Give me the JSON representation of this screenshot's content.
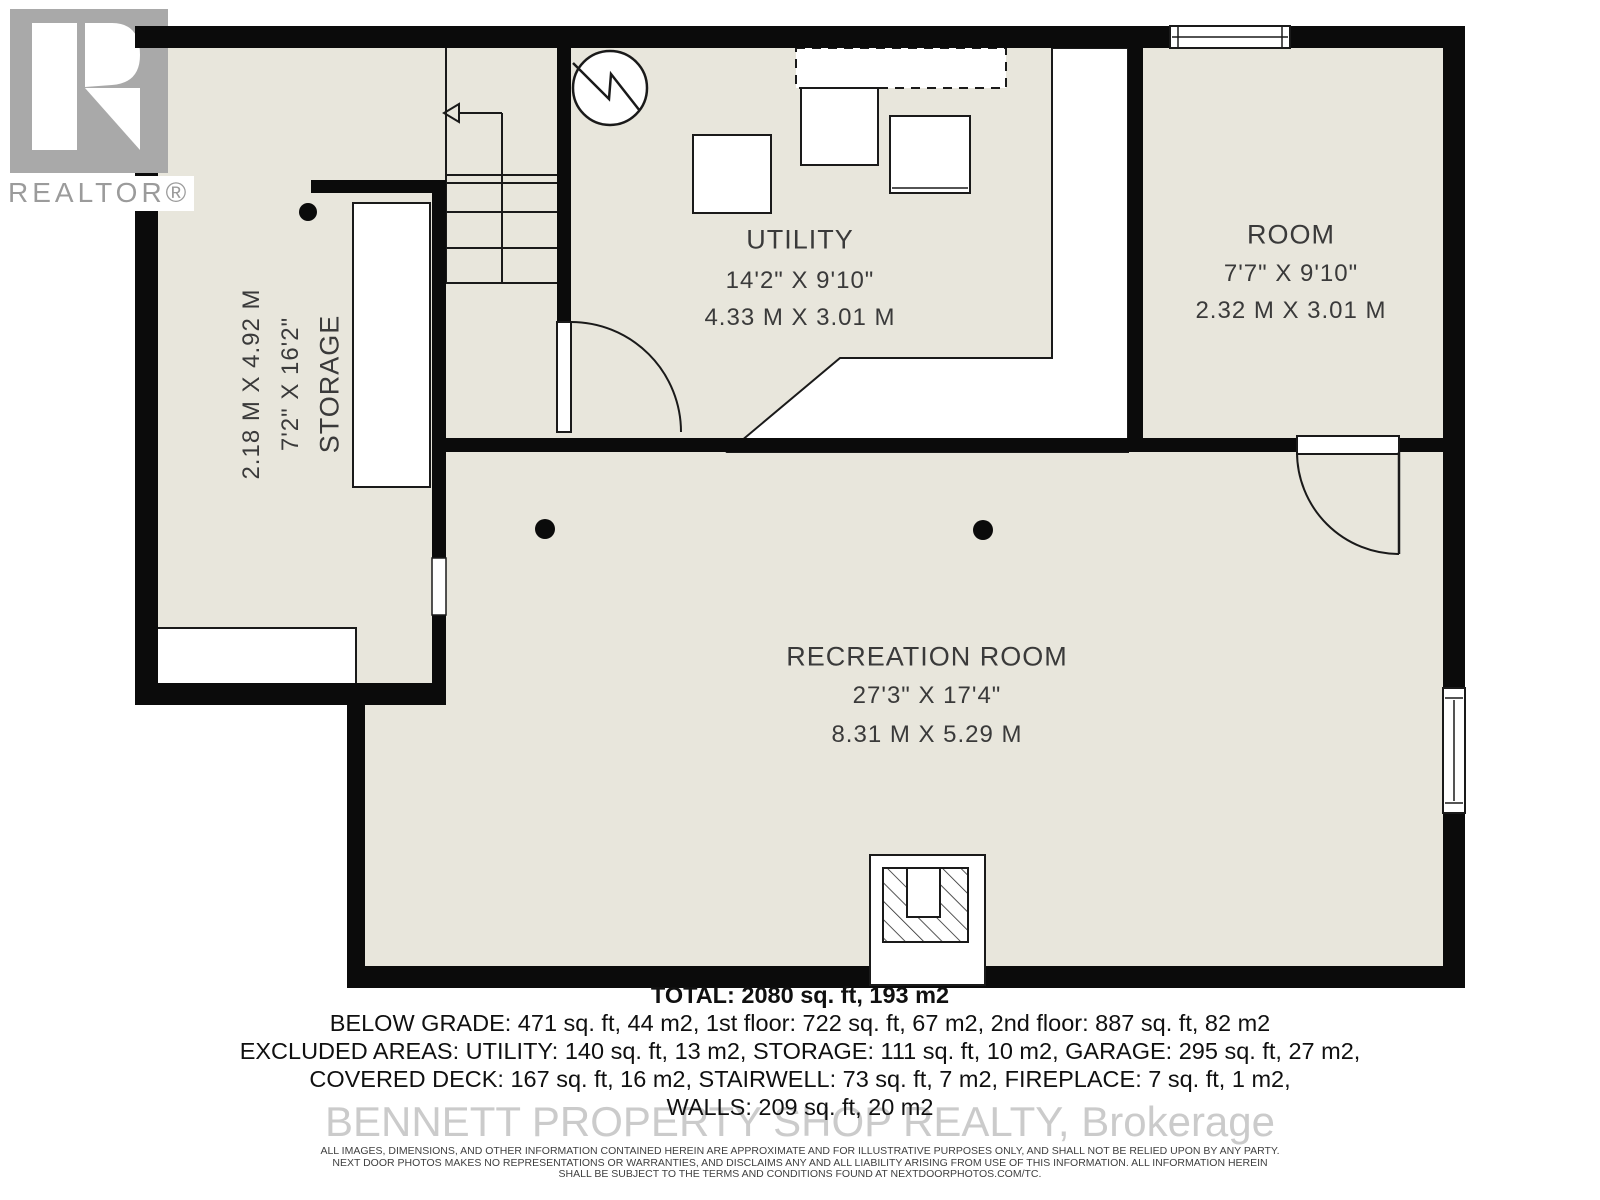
{
  "logo": {
    "brand": "REALTOR®"
  },
  "rooms": {
    "utility": {
      "name": "UTILITY",
      "dim_imperial": "14'2\" X 9'10\"",
      "dim_metric": "4.33 M X 3.01 M"
    },
    "room": {
      "name": "ROOM",
      "dim_imperial": "7'7\" X 9'10\"",
      "dim_metric": "2.32 M X 3.01 M"
    },
    "recreation": {
      "name": "RECREATION ROOM",
      "dim_imperial": "27'3\" X 17'4\"",
      "dim_metric": "8.31 M X 5.29 M"
    },
    "storage": {
      "name": "STORAGE",
      "dim_imperial": "7'2\" X 16'2\"",
      "dim_metric": "2.18 M X 4.92 M"
    }
  },
  "summary": {
    "total": "TOTAL: 2080 sq. ft, 193 m2",
    "below_grade": "BELOW GRADE: 471 sq. ft, 44 m2, 1st floor: 722 sq. ft, 67 m2, 2nd floor: 887 sq. ft, 82 m2",
    "excluded_1": "EXCLUDED AREAS: UTILITY: 140 sq. ft, 13 m2, STORAGE: 111 sq. ft, 10 m2, GARAGE: 295 sq. ft, 27 m2,",
    "excluded_2": "COVERED DECK: 167 sq. ft, 16 m2, STAIRWELL: 73 sq. ft, 7 m2, FIREPLACE: 7 sq. ft, 1 m2,",
    "walls": "WALLS: 209 sq. ft, 20 m2"
  },
  "watermark": "BENNETT PROPERTY SHOP REALTY, Brokerage",
  "disclaimer": {
    "line1": "ALL IMAGES, DIMENSIONS, AND OTHER INFORMATION CONTAINED HEREIN ARE APPROXIMATE AND FOR ILLUSTRATIVE PURPOSES ONLY, AND SHALL NOT BE RELIED UPON BY ANY PARTY.",
    "line2": "NEXT DOOR PHOTOS MAKES NO REPRESENTATIONS OR WARRANTIES, AND DISCLAIMS ANY AND ALL LIABILITY ARISING FROM USE OF THIS INFORMATION. ALL INFORMATION HEREIN",
    "line3": "SHALL BE SUBJECT TO THE TERMS AND CONDITIONS FOUND AT NEXTDOORPHOTOS.COM/TC."
  },
  "colors": {
    "room_fill": "#e8e6dc",
    "wall": "#0b0b0b",
    "logo_gray": "#a9a9a9",
    "watermark_gray": "#cbcbcb"
  }
}
